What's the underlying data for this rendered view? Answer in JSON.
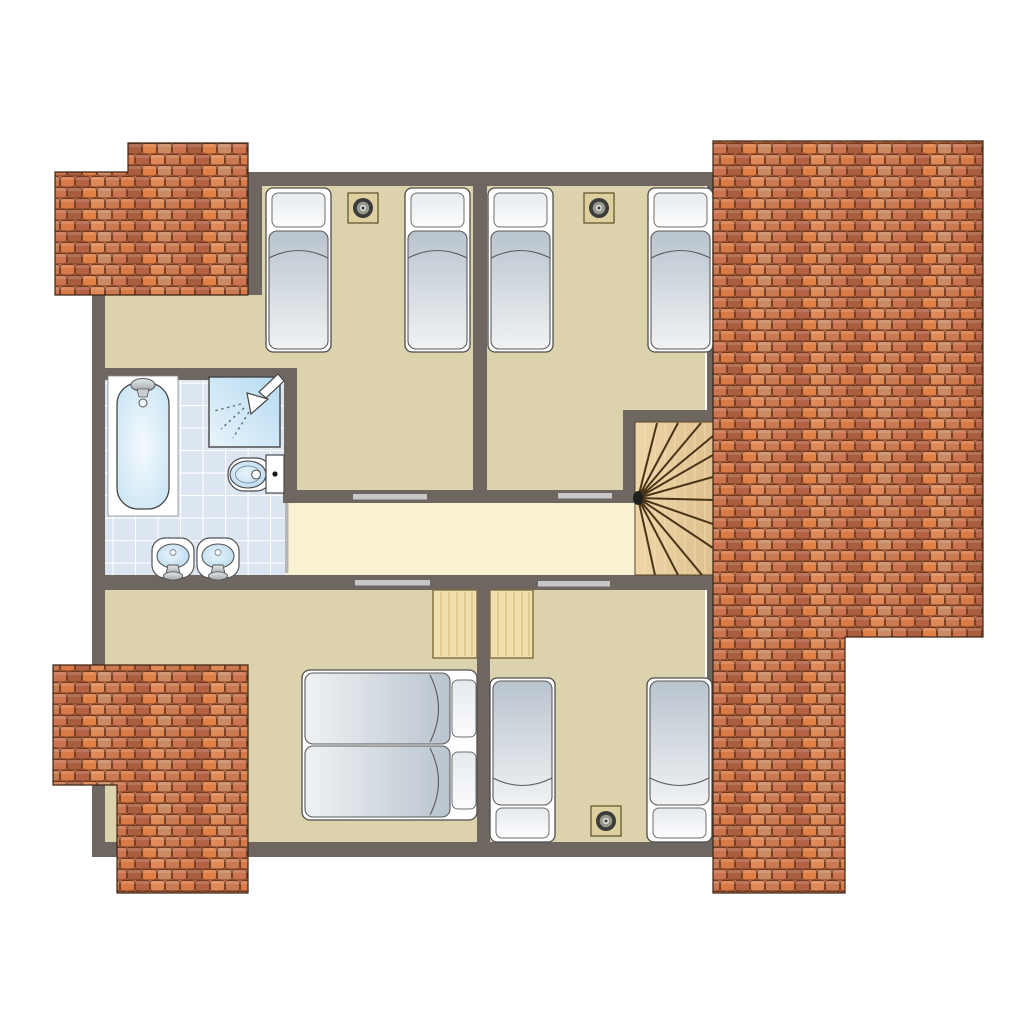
{
  "plan": {
    "kind": "residential-floor-plan",
    "rooms": [
      {
        "name": "bedroom-top-left",
        "furniture": [
          "single-bed",
          "single-bed",
          "ceiling-spotlight"
        ]
      },
      {
        "name": "bedroom-top-right",
        "furniture": [
          "single-bed",
          "single-bed",
          "ceiling-spotlight"
        ]
      },
      {
        "name": "bathroom",
        "furniture": [
          "bathtub",
          "shower",
          "toilet",
          "washbasin",
          "washbasin"
        ]
      },
      {
        "name": "hallway",
        "furniture": []
      },
      {
        "name": "stairwell",
        "furniture": [
          "winder-staircase"
        ]
      },
      {
        "name": "bedroom-bottom-left",
        "furniture": [
          "double-bed",
          "desk"
        ]
      },
      {
        "name": "bedroom-bottom-right",
        "furniture": [
          "single-bed",
          "single-bed",
          "desk",
          "ceiling-spotlight"
        ]
      }
    ],
    "door_openings": 5,
    "roof_sections": [
      "top-left",
      "right",
      "bottom-left"
    ]
  },
  "colors": {
    "background": "#ffffff",
    "wall": "#6e6660",
    "floor_tan": "#dcd2ab",
    "floor_hall": "#f8f1d2",
    "bath_tile": "#dce6f1",
    "tile_grout": "#ffffff",
    "roof_terracotta": "#d97a49",
    "roof_dark": "#a95f3f",
    "roof_outline": "#713a1f",
    "stair_wood": "#e8cd9c",
    "desk_wood": "#f0dfae",
    "bed_mattress": "#b9c4ce",
    "fixture_blue": "#bfdff2",
    "door_strip": "#c7c7c7"
  }
}
